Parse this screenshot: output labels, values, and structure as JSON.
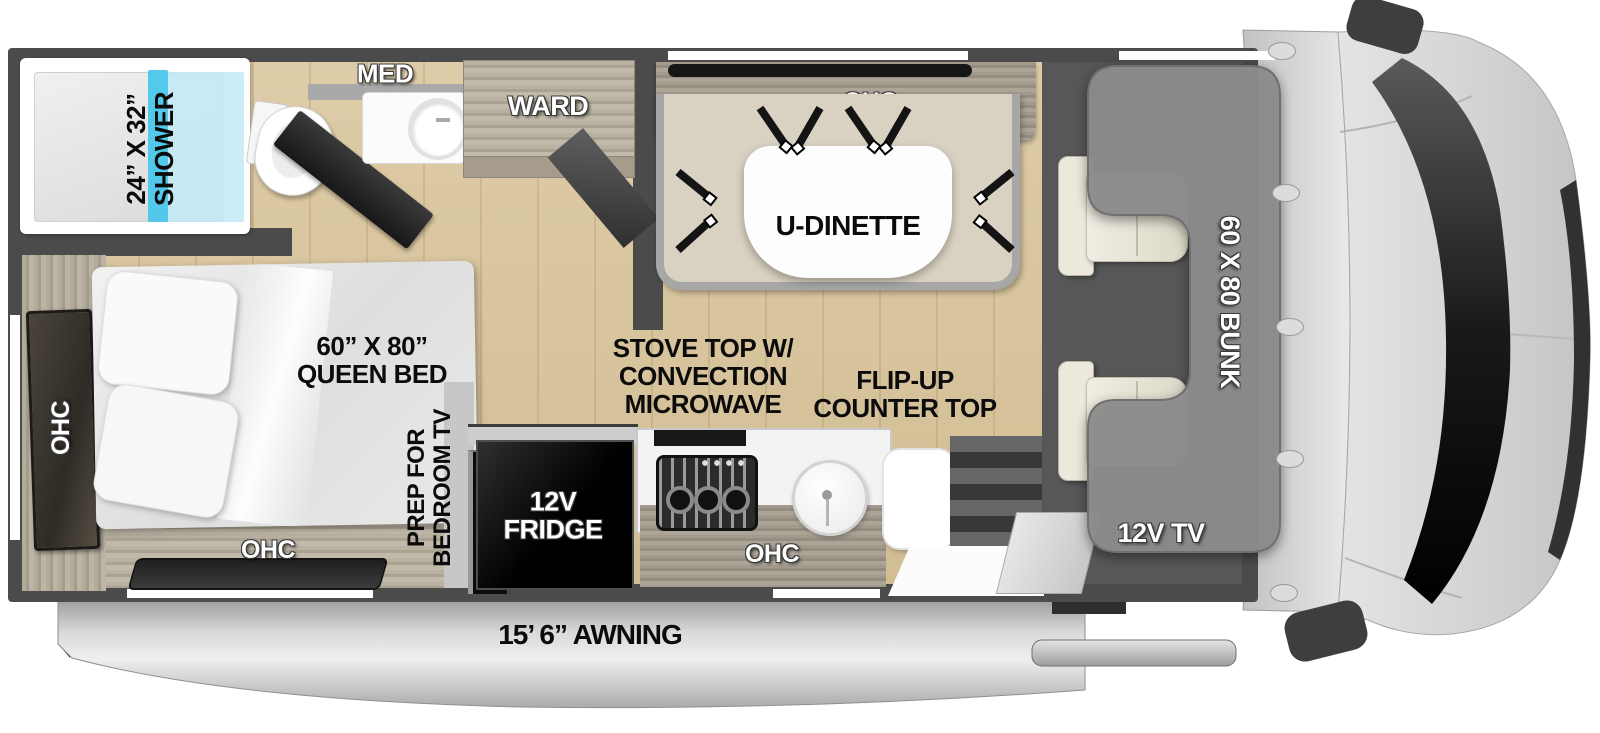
{
  "meta": {
    "description": "RV class-C motorhome floor plan, top-down view"
  },
  "rooms": {
    "bathroom": {
      "shower_size": "24” X 32”",
      "shower": "SHOWER",
      "med_cabinet": "MED",
      "wardrobe": "WARD"
    },
    "dinette": {
      "overhead": "OHC",
      "table": "U-DINETTE"
    },
    "bedroom": {
      "size": "60” X 80”",
      "name": "QUEEN BED",
      "overhead_side": "OHC",
      "overhead_rear": "OHC",
      "tv_prep_1": "PREP FOR",
      "tv_prep_2": "BEDROOM TV"
    },
    "kitchen": {
      "stove_1": "STOVE TOP W/",
      "stove_2": "CONVECTION",
      "stove_3": "MICROWAVE",
      "flip_1": "FLIP-UP",
      "flip_2": "COUNTER TOP",
      "fridge_1": "12V",
      "fridge_2": "FRIDGE",
      "overhead": "OHC"
    },
    "cab": {
      "bunk": "60 X 80 BUNK",
      "tv": "12V TV"
    },
    "exterior": {
      "awning": "15’ 6” AWNING"
    }
  },
  "colors": {
    "wall": "#4b4b4b",
    "floor_wood": "#d9c6a1",
    "shower_glass": "#45c6ea",
    "bench_cream": "#d9d2c2",
    "bunk_gray": "#8d8d8d",
    "awning_silver": "#c8c8c8",
    "windshield_black": "#0a0a0a"
  }
}
